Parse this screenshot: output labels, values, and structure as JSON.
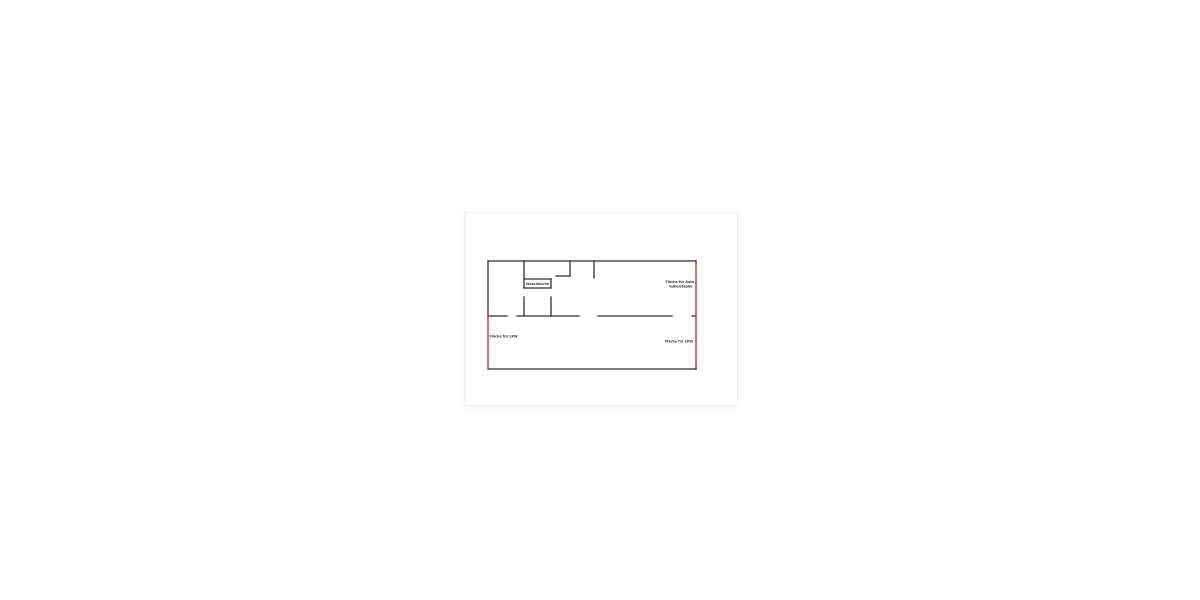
{
  "page": {
    "background": "#ffffff"
  },
  "card": {
    "background": "#ffffff",
    "border_color": "#ededed"
  },
  "floor_plan": {
    "colors": {
      "wall": "#2f2f2f",
      "highlight_wall": "#cc2222",
      "label_text": "#333333"
    },
    "labels": {
      "small_room": "Waschküche",
      "top_right_line1": "Fläche für Auto /",
      "top_right_line2": "Gabelstapler",
      "bottom_left": "Fläche für LKW",
      "bottom_right": "Fläche für LKW"
    },
    "walls_black": [
      [
        1,
        1,
        209,
        1
      ],
      [
        1,
        109,
        209,
        109
      ],
      [
        1,
        1,
        1,
        56
      ],
      [
        209,
        1,
        209,
        3
      ],
      [
        209,
        107,
        209,
        109
      ],
      [
        1,
        56,
        20,
        56
      ],
      [
        30,
        56,
        92,
        56
      ],
      [
        111,
        56,
        185,
        56
      ],
      [
        205,
        56,
        209,
        56
      ],
      [
        37,
        1,
        37,
        28
      ],
      [
        37,
        19,
        64,
        19
      ],
      [
        64,
        19,
        64,
        28
      ],
      [
        37,
        28,
        64,
        28
      ],
      [
        37,
        37,
        37,
        56
      ],
      [
        64,
        37,
        64,
        56
      ],
      [
        83,
        1,
        83,
        16
      ],
      [
        69,
        16,
        83,
        16
      ],
      [
        107,
        1,
        107,
        18
      ]
    ],
    "walls_red": [
      [
        1,
        56,
        1,
        108
      ],
      [
        209,
        3,
        209,
        107
      ]
    ]
  }
}
